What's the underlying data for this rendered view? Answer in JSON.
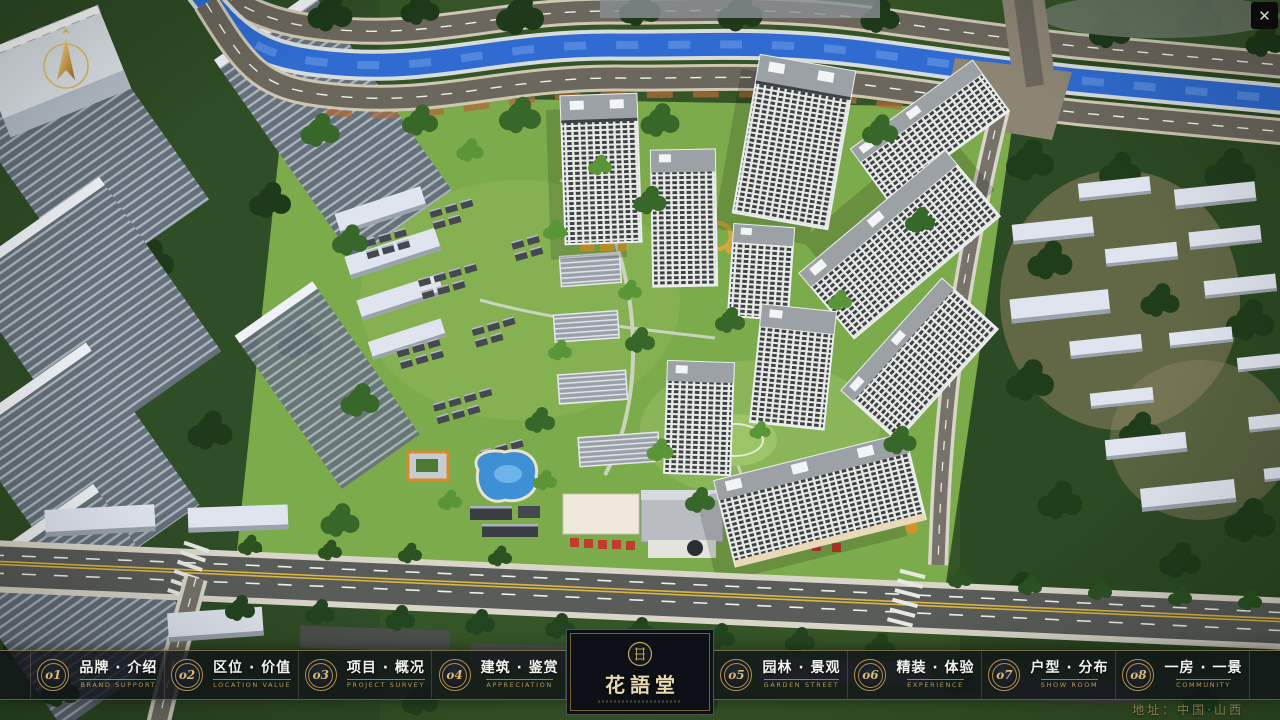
{
  "window": {
    "close": "✕"
  },
  "logo": {
    "name": "花語堂"
  },
  "nav": {
    "items": [
      {
        "num": "o1",
        "zh": "品牌 · 介绍",
        "en": "BRAND SUPPORT"
      },
      {
        "num": "o2",
        "zh": "区位 · 价值",
        "en": "LOCATION VALUE"
      },
      {
        "num": "o3",
        "zh": "项目 · 概况",
        "en": "PROJECT SURVEY"
      },
      {
        "num": "o4",
        "zh": "建筑 · 鉴赏",
        "en": "APPRECIATION"
      },
      {
        "num": "o5",
        "zh": "园林 · 景观",
        "en": "GARDEN STREET"
      },
      {
        "num": "o6",
        "zh": "精装 · 体验",
        "en": "EXPERIENCE"
      },
      {
        "num": "o7",
        "zh": "户型 · 分布",
        "en": "SHOW ROOM"
      },
      {
        "num": "o8",
        "zh": "一房 · 一景",
        "en": "COMMUNITY"
      }
    ]
  },
  "footer": {
    "address": "地址：中国·山西"
  },
  "colors": {
    "accent_gold": "#c9a85c",
    "bar_background": "rgba(15,19,24,0.8)",
    "river_blue": "#2f6bd0",
    "lawn_green": "#7cab4b"
  }
}
